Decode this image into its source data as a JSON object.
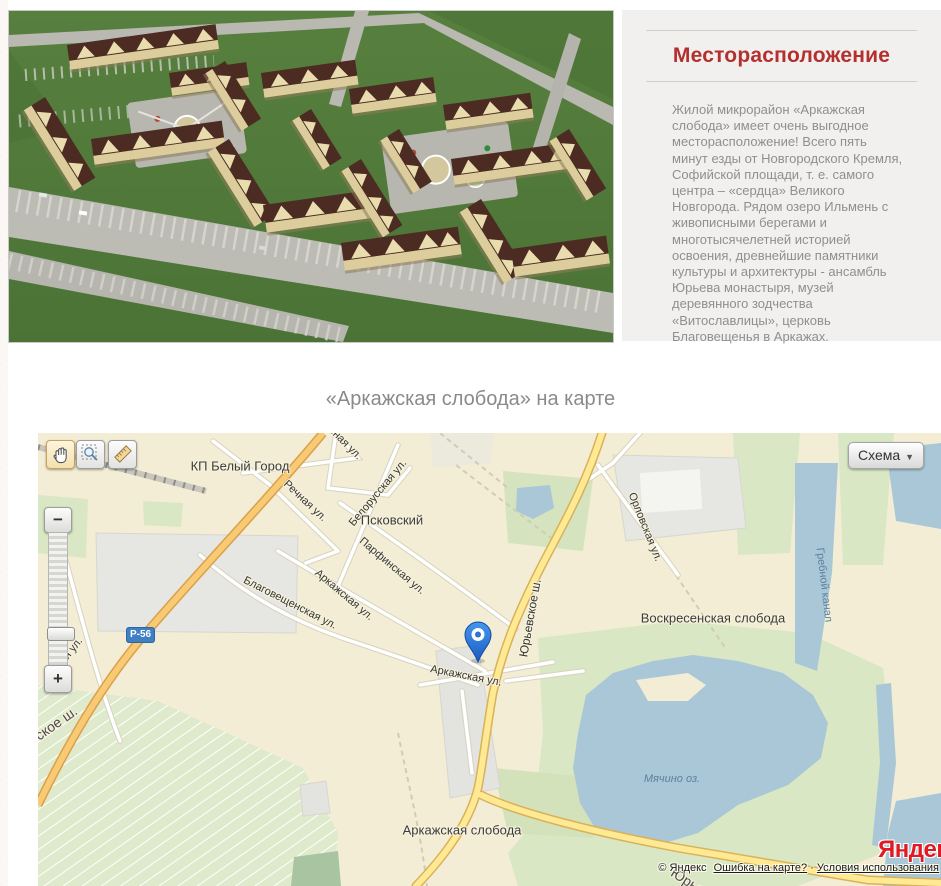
{
  "colors": {
    "accent_red": "#b3302f",
    "panel_bg": "#f1f0ee",
    "body_text": "#8f8f8f",
    "map_land": "#f3edd5",
    "map_water": "#a9c7d6",
    "map_green": "#d9e7c4",
    "road_yellow": "#ffe992",
    "road_orange": "#f8ca74",
    "badge_blue": "#3f7fc4",
    "logo_red": "#e01a22"
  },
  "top_section": {
    "heading": "Месторасположение",
    "paragraph": "Жилой микрорайон «Аркажская слобода» имеет очень выгодное месторасположение! Всего пять минут езды от Новгородского Кремля, Софийской площади, т. е. самого центра – «сердца» Великого Новгорода. Рядом озеро Ильмень с живописными берегами и многотысячелетней историей освоения, древнейшие памятники культуры и архитектуры - ансамбль Юрьева монастыря, музей деревянного зодчества «Витославлицы», церковь Благовещенья в Аркажах."
  },
  "map_section": {
    "title": "«Аркажская слобода» на карте",
    "controls": {
      "layer_label": "Схема",
      "layer_arrow": "▼",
      "zoom_in": "+",
      "zoom_out": "−"
    },
    "road_badge": "Р-56",
    "labels": {
      "kp_bely_gorod": "КП Белый Город",
      "rnaya_ul": "рная ул.",
      "rechnaya_ul": "Речная ул.",
      "belorusskaya_ul": "Белорусская ул.",
      "pskovskiy": "Псковский",
      "parfinskaya_ul": "Парфинская ул.",
      "arkazhskaya_ul_1": "Аркажская ул.",
      "blagoveshchenskaya_ul": "Благовещенская ул.",
      "orlovskaya_ul": "Орловская ул.",
      "yuryevskoe_sh": "Юрьевское ш.",
      "arkazhskaya_ul_2": "Аркажская ул.",
      "voskresenskaya_sloboda": "Воскресенская слобода",
      "grebnoy_kanal": "Гребной канал",
      "skaya_ul_partial": "ская ул.",
      "skoe_sh_partial": "ское ш.",
      "myachino_oz": "Мячино оз.",
      "arkazhskaya_sloboda": "Аркажская слобода",
      "yur_partial": "Юрье"
    },
    "attribution": {
      "copyright": "© Яндекс",
      "report": "Ошибка на карте?",
      "dot": "·",
      "terms": "Условия использования",
      "logo": "Яндекс"
    }
  }
}
